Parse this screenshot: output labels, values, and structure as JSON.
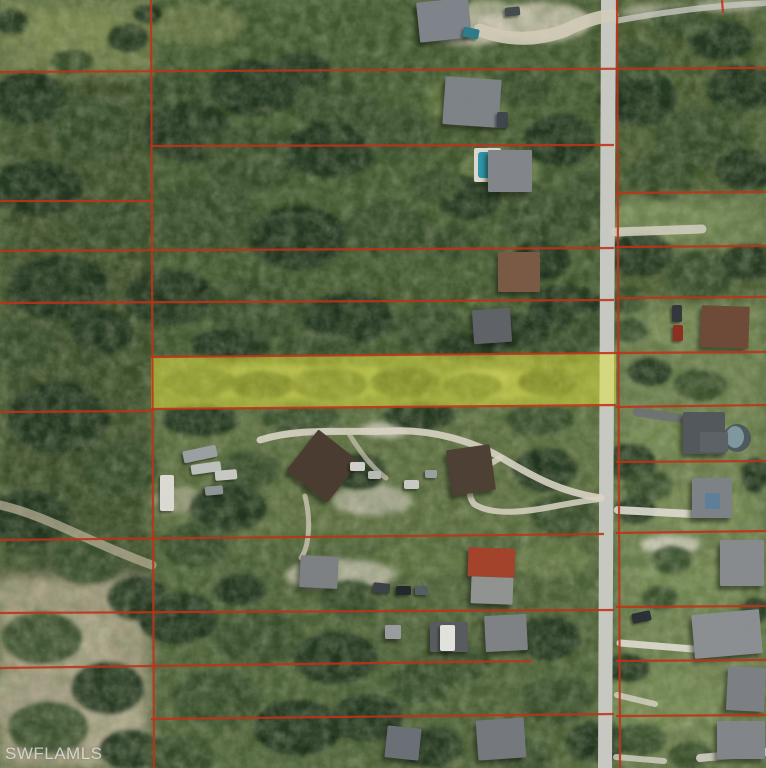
{
  "watermark": {
    "text": "SWFLAMLS"
  },
  "canvas": {
    "width": 766,
    "height": 768
  },
  "palette": {
    "base_vegetation": "#55683e",
    "parcel_line": "#c03318",
    "highlight_fill": "#e3e63c",
    "highlight_opacity": 0.5,
    "road": "#c7c8c2",
    "watermark_color": "rgba(232,232,230,0.78)"
  },
  "road": {
    "main_polygon": "601,0 616,0 612,768 598,768",
    "branch_path": "M610,22 C652,14 704,6 766,3"
  },
  "highlighted_parcel": {
    "points": "151,357 616,353 616,406 151,409"
  },
  "parcel_lines": [
    [
      0,
      72,
      766,
      68
    ],
    [
      151,
      146,
      614,
      145
    ],
    [
      616,
      193,
      766,
      192
    ],
    [
      0,
      201,
      151,
      201
    ],
    [
      0,
      251,
      614,
      248
    ],
    [
      616,
      247,
      766,
      246
    ],
    [
      0,
      303,
      614,
      300
    ],
    [
      616,
      298,
      766,
      297
    ],
    [
      151,
      357,
      616,
      353
    ],
    [
      616,
      353,
      766,
      352
    ],
    [
      0,
      412,
      151,
      411
    ],
    [
      151,
      409,
      616,
      405
    ],
    [
      616,
      407,
      766,
      405
    ],
    [
      616,
      462,
      766,
      461
    ],
    [
      0,
      540,
      604,
      534
    ],
    [
      616,
      533,
      766,
      531
    ],
    [
      0,
      613,
      614,
      610
    ],
    [
      616,
      607,
      766,
      606
    ],
    [
      0,
      668,
      532,
      661
    ],
    [
      616,
      661,
      766,
      660
    ],
    [
      151,
      719,
      614,
      714
    ],
    [
      616,
      716,
      766,
      715
    ],
    [
      151,
      0,
      154,
      768
    ],
    [
      617,
      0,
      620,
      768
    ],
    [
      722,
      0,
      723,
      13
    ]
  ],
  "zones": [
    [
      0,
      0,
      152,
      76,
      "#727e4b"
    ],
    [
      0,
      74,
      152,
      516,
      "#3a4c2c"
    ],
    [
      152,
      0,
      464,
      362,
      "#41542f"
    ],
    [
      616,
      0,
      150,
      200,
      "#44562f"
    ],
    [
      616,
      196,
      150,
      56,
      "#6d8050"
    ],
    [
      616,
      250,
      150,
      54,
      "#47582f"
    ],
    [
      616,
      302,
      150,
      466,
      "#6f8251"
    ],
    [
      0,
      578,
      148,
      190,
      "#a59c82"
    ],
    [
      152,
      406,
      464,
      136,
      "#5b6e41"
    ],
    [
      152,
      540,
      464,
      228,
      "#4d6037"
    ]
  ],
  "grass_patches": [
    [
      72,
      32,
      44,
      20,
      "#7d8852",
      0.9
    ],
    [
      195,
      25,
      50,
      20,
      "#6d7a48",
      0.8
    ],
    [
      470,
      100,
      45,
      25,
      "#6d8049",
      0.7
    ],
    [
      500,
      170,
      40,
      20,
      "#70834b",
      0.7
    ],
    [
      300,
      382,
      120,
      18,
      "#8e9c5c",
      0.8
    ],
    [
      500,
      384,
      60,
      15,
      "#96a362",
      0.8
    ],
    [
      480,
      380,
      30,
      11,
      "#aab077",
      0.8
    ],
    [
      660,
      222,
      60,
      18,
      "#7b8e58",
      0.8
    ],
    [
      700,
      330,
      50,
      20,
      "#7d9058",
      0.8
    ],
    [
      690,
      435,
      60,
      25,
      "#788b54",
      0.7
    ],
    [
      700,
      510,
      55,
      22,
      "#7a8d56",
      0.7
    ],
    [
      690,
      580,
      55,
      22,
      "#788b54",
      0.7
    ],
    [
      660,
      700,
      60,
      30,
      "#7a8d57",
      0.7
    ],
    [
      550,
      560,
      40,
      18,
      "#6d8049",
      0.7
    ],
    [
      420,
      560,
      50,
      18,
      "#687b46",
      0.6
    ]
  ],
  "sand_patches": [
    [
      540,
      22,
      52,
      20,
      "#d0c9b6",
      0.9
    ],
    [
      488,
      12,
      26,
      12,
      "#cdc6b2",
      0.8
    ],
    [
      470,
      30,
      40,
      16,
      "#cec7b4",
      0.85
    ],
    [
      60,
      642,
      54,
      34,
      "#b2aa91",
      0.9
    ],
    [
      28,
      700,
      44,
      28,
      "#a9a088",
      0.9
    ],
    [
      102,
      722,
      40,
      24,
      "#b6ae95",
      0.85
    ],
    [
      22,
      600,
      34,
      20,
      "#a79e85",
      0.8
    ],
    [
      140,
      592,
      24,
      13,
      "#9f987f",
      0.7
    ],
    [
      372,
      500,
      40,
      16,
      "#c3bdac",
      0.8
    ],
    [
      180,
      500,
      28,
      13,
      "#b5ae99",
      0.7
    ],
    [
      305,
      425,
      28,
      9,
      "#ddd9cc",
      0.9
    ],
    [
      385,
      430,
      24,
      8,
      "#d8d4c6",
      0.85
    ],
    [
      660,
      12,
      40,
      8,
      "#c6c1ae",
      0.7
    ],
    [
      730,
      5,
      34,
      7,
      "#c9c4b2",
      0.7
    ],
    [
      670,
      545,
      30,
      10,
      "#d6d2c6",
      0.85
    ],
    [
      340,
      575,
      55,
      16,
      "#c9c3b2",
      0.85
    ]
  ],
  "tree_blobs": [
    [
      28,
      98,
      38,
      26,
      0
    ],
    [
      92,
      128,
      42,
      30,
      1
    ],
    [
      38,
      188,
      46,
      28,
      0
    ],
    [
      112,
      226,
      36,
      26,
      1
    ],
    [
      58,
      288,
      50,
      32,
      0
    ],
    [
      18,
      348,
      36,
      26,
      1
    ],
    [
      102,
      332,
      32,
      22,
      0
    ],
    [
      58,
      418,
      50,
      36,
      0
    ],
    [
      122,
      468,
      36,
      28,
      1
    ],
    [
      28,
      518,
      42,
      28,
      0
    ],
    [
      88,
      558,
      38,
      26,
      1
    ],
    [
      138,
      598,
      30,
      22,
      0
    ],
    [
      42,
      638,
      40,
      26,
      1
    ],
    [
      108,
      688,
      36,
      26,
      0
    ],
    [
      48,
      728,
      40,
      26,
      1
    ],
    [
      130,
      750,
      30,
      20,
      0
    ],
    [
      12,
      22,
      16,
      12,
      0
    ],
    [
      128,
      38,
      20,
      14,
      0
    ],
    [
      72,
      62,
      22,
      12,
      1
    ],
    [
      148,
      14,
      14,
      10,
      0
    ],
    [
      178,
      96,
      40,
      26,
      1
    ],
    [
      255,
      88,
      46,
      28,
      0
    ],
    [
      338,
      106,
      44,
      26,
      1
    ],
    [
      300,
      70,
      30,
      18,
      0
    ],
    [
      188,
      132,
      46,
      30,
      0
    ],
    [
      252,
      158,
      50,
      34,
      1
    ],
    [
      330,
      150,
      46,
      28,
      0
    ],
    [
      398,
      132,
      36,
      24,
      1
    ],
    [
      206,
      218,
      54,
      36,
      1
    ],
    [
      298,
      238,
      50,
      32,
      0
    ],
    [
      388,
      228,
      42,
      28,
      1
    ],
    [
      170,
      298,
      46,
      28,
      0
    ],
    [
      258,
      308,
      50,
      32,
      1
    ],
    [
      348,
      318,
      46,
      26,
      0
    ],
    [
      428,
      328,
      36,
      24,
      1
    ],
    [
      520,
      88,
      32,
      20,
      1
    ],
    [
      560,
      140,
      36,
      26,
      0
    ],
    [
      540,
      218,
      40,
      28,
      1
    ],
    [
      565,
      308,
      36,
      24,
      0
    ],
    [
      470,
      198,
      32,
      22,
      0
    ],
    [
      452,
      242,
      28,
      18,
      1
    ],
    [
      540,
      260,
      30,
      20,
      0
    ],
    [
      588,
      200,
      24,
      30,
      1
    ],
    [
      590,
      330,
      26,
      18,
      1
    ],
    [
      436,
      186,
      26,
      16,
      1
    ],
    [
      520,
      330,
      30,
      18,
      0
    ],
    [
      638,
      98,
      40,
      28,
      0
    ],
    [
      700,
      138,
      46,
      30,
      1
    ],
    [
      742,
      88,
      36,
      24,
      0
    ],
    [
      660,
      178,
      36,
      22,
      1
    ],
    [
      745,
      170,
      30,
      20,
      0
    ],
    [
      640,
      60,
      30,
      18,
      1
    ],
    [
      720,
      40,
      34,
      20,
      0
    ],
    [
      680,
      22,
      30,
      16,
      1
    ],
    [
      640,
      255,
      34,
      22,
      0
    ],
    [
      700,
      275,
      38,
      24,
      1
    ],
    [
      750,
      262,
      28,
      18,
      0
    ],
    [
      625,
      300,
      20,
      14,
      1
    ],
    [
      630,
      330,
      18,
      12,
      1
    ],
    [
      650,
      372,
      22,
      14,
      0
    ],
    [
      700,
      385,
      26,
      16,
      1
    ],
    [
      630,
      462,
      26,
      18,
      0
    ],
    [
      648,
      485,
      24,
      16,
      1
    ],
    [
      636,
      510,
      20,
      14,
      0
    ],
    [
      660,
      598,
      18,
      12,
      1
    ],
    [
      628,
      668,
      22,
      14,
      0
    ],
    [
      640,
      740,
      26,
      16,
      1
    ],
    [
      755,
      475,
      14,
      18,
      0
    ],
    [
      200,
      382,
      36,
      15,
      1
    ],
    [
      262,
      385,
      32,
      14,
      0
    ],
    [
      330,
      384,
      38,
      16,
      1
    ],
    [
      405,
      382,
      34,
      15,
      0
    ],
    [
      472,
      386,
      30,
      13,
      1
    ],
    [
      548,
      382,
      30,
      14,
      0
    ],
    [
      230,
      345,
      40,
      16,
      0
    ],
    [
      320,
      350,
      44,
      16,
      1
    ],
    [
      470,
      348,
      36,
      14,
      0
    ],
    [
      560,
      352,
      30,
      12,
      1
    ],
    [
      200,
      420,
      38,
      16,
      0
    ],
    [
      300,
      418,
      40,
      16,
      1
    ],
    [
      420,
      416,
      36,
      14,
      0
    ],
    [
      540,
      420,
      34,
      16,
      1
    ],
    [
      250,
      470,
      30,
      20,
      1
    ],
    [
      360,
      472,
      26,
      18,
      0
    ],
    [
      545,
      470,
      32,
      22,
      0
    ],
    [
      565,
      515,
      34,
      22,
      1
    ],
    [
      228,
      508,
      38,
      24,
      0
    ],
    [
      195,
      545,
      34,
      22,
      1
    ],
    [
      178,
      618,
      40,
      26,
      0
    ],
    [
      258,
      638,
      46,
      28,
      1
    ],
    [
      336,
      658,
      42,
      26,
      0
    ],
    [
      218,
      698,
      46,
      28,
      1
    ],
    [
      298,
      728,
      44,
      28,
      0
    ],
    [
      178,
      756,
      36,
      22,
      1
    ],
    [
      368,
      718,
      36,
      24,
      0
    ],
    [
      420,
      682,
      32,
      22,
      1
    ],
    [
      548,
      638,
      32,
      22,
      0
    ],
    [
      556,
      700,
      36,
      24,
      1
    ],
    [
      596,
      742,
      30,
      20,
      0
    ],
    [
      462,
      664,
      28,
      18,
      1
    ],
    [
      432,
      748,
      30,
      20,
      0
    ],
    [
      525,
      756,
      28,
      18,
      1
    ],
    [
      350,
      600,
      30,
      20,
      1
    ],
    [
      240,
      590,
      26,
      16,
      0
    ],
    [
      672,
      560,
      20,
      14,
      1
    ],
    [
      756,
      610,
      16,
      12,
      0
    ],
    [
      690,
      756,
      22,
      14,
      1
    ]
  ],
  "driveways": [
    [
      "M601,498 C560,492 532,476 502,458 C472,441 432,429 390,431 C345,433 302,427 260,440",
      7,
      "#d9d3c4",
      0.9
    ],
    [
      "M500,458 C478,470 462,488 474,504 C492,516 526,512 556,506 C572,503 590,500 601,499",
      6,
      "#d9d3c4",
      0.85
    ],
    [
      "M616,232 L702,229",
      9,
      "#d5d0c2",
      0.85
    ],
    [
      "M618,510 L692,514",
      8,
      "#dfdcd2",
      0.9
    ],
    [
      "M620,643 L693,649",
      7,
      "#dfdcd2",
      0.9
    ],
    [
      "M617,695 L655,704",
      6,
      "#d8d5c8",
      0.8
    ],
    [
      "M480,30 C510,42 540,40 566,30 C584,21 598,17 612,15",
      13,
      "#d2cbb8",
      0.9
    ],
    [
      "M0,505 C45,515 95,545 152,565",
      9,
      "#b6ad94",
      0.75
    ],
    [
      "M637,412 L684,419",
      9,
      "#6f7173",
      0.9
    ],
    [
      "M305,496 C312,524 308,548 301,558",
      5,
      "#ccc5b4",
      0.8
    ],
    [
      "M700,758 L766,752",
      8,
      "#d8d5cc",
      0.85
    ],
    [
      "M616,757 L664,761",
      6,
      "#d4d1c8",
      0.8
    ],
    [
      "M348,432 C360,452 372,468 386,478",
      5,
      "#ccc5b4",
      0.7
    ]
  ],
  "houses": [
    [
      418,
      0,
      52,
      40,
      -6,
      "#7e848a"
    ],
    [
      444,
      78,
      56,
      48,
      4,
      "#7d8387"
    ],
    [
      488,
      150,
      44,
      42,
      0,
      "#82868a"
    ],
    [
      498,
      252,
      42,
      40,
      0,
      "#7a5a44"
    ],
    [
      473,
      309,
      38,
      34,
      -4,
      "#5f6367"
    ],
    [
      297,
      440,
      52,
      52,
      38,
      "#4a3c30"
    ],
    [
      449,
      447,
      44,
      46,
      -8,
      "#4e4034"
    ],
    [
      300,
      556,
      38,
      32,
      3,
      "#7d8184"
    ],
    [
      468,
      548,
      47,
      29,
      2,
      "#a3432c"
    ],
    [
      471,
      577,
      42,
      27,
      2,
      "#90938f"
    ],
    [
      430,
      622,
      38,
      30,
      0,
      "#585c5e"
    ],
    [
      485,
      615,
      42,
      36,
      -3,
      "#7e8285"
    ],
    [
      477,
      719,
      48,
      40,
      -4,
      "#75797d"
    ],
    [
      385,
      625,
      16,
      14,
      0,
      "#9a9da0"
    ],
    [
      701,
      306,
      48,
      42,
      2,
      "#6e4a38"
    ],
    [
      683,
      412,
      42,
      42,
      0,
      "#53585c"
    ],
    [
      700,
      432,
      28,
      20,
      0,
      "#5d6266"
    ],
    [
      692,
      478,
      40,
      40,
      0,
      "#7d8286"
    ],
    [
      705,
      493,
      15,
      16,
      0,
      "#5d7f99"
    ],
    [
      720,
      540,
      44,
      46,
      0,
      "#878b8e"
    ],
    [
      693,
      612,
      68,
      44,
      -5,
      "#8b8f92"
    ],
    [
      727,
      667,
      38,
      44,
      3,
      "#7c8084"
    ],
    [
      717,
      721,
      48,
      38,
      0,
      "#82868a"
    ],
    [
      386,
      727,
      34,
      32,
      6,
      "#6a7076"
    ]
  ],
  "trailers": [
    [
      183,
      448,
      34,
      12,
      -12,
      "#9aa0a2"
    ],
    [
      191,
      463,
      30,
      10,
      -8,
      "#bcc0bd"
    ],
    [
      160,
      475,
      14,
      36,
      0,
      "#dad9d2"
    ],
    [
      215,
      470,
      22,
      10,
      -5,
      "#c6c8c4"
    ],
    [
      205,
      486,
      18,
      9,
      -5,
      "#8f9494"
    ],
    [
      440,
      625,
      15,
      26,
      0,
      "#e2e2dc"
    ]
  ],
  "vehicles": [
    [
      463,
      28,
      16,
      10,
      12,
      "#2e7b8a"
    ],
    [
      505,
      7,
      15,
      9,
      -6,
      "#474c50"
    ],
    [
      497,
      112,
      11,
      16,
      0,
      "#3f464c"
    ],
    [
      672,
      305,
      10,
      17,
      0,
      "#33383c"
    ],
    [
      673,
      325,
      10,
      16,
      0,
      "#8d2f20"
    ],
    [
      632,
      612,
      19,
      10,
      -12,
      "#2c3136"
    ],
    [
      373,
      583,
      17,
      10,
      6,
      "#3c4248"
    ],
    [
      396,
      586,
      15,
      9,
      0,
      "#23282c"
    ],
    [
      415,
      586,
      13,
      9,
      0,
      "#565e64"
    ],
    [
      350,
      462,
      15,
      9,
      0,
      "#cfd0cb"
    ],
    [
      368,
      471,
      13,
      8,
      0,
      "#b8bab6"
    ],
    [
      404,
      480,
      15,
      9,
      0,
      "#c8c9c4"
    ],
    [
      425,
      470,
      12,
      8,
      0,
      "#9aa0a0"
    ]
  ],
  "pools": {
    "rect_pool_deck": [
      474,
      148,
      27,
      34,
      "#dcd8cc"
    ],
    "rect_pool_water": [
      478,
      152,
      19,
      26,
      "#2f95a8"
    ],
    "round_pool_center": [
      737,
      438,
      14,
      "#4f5a5e"
    ],
    "round_pool_water": [
      735,
      437,
      9,
      11,
      "#7e98a0"
    ]
  }
}
